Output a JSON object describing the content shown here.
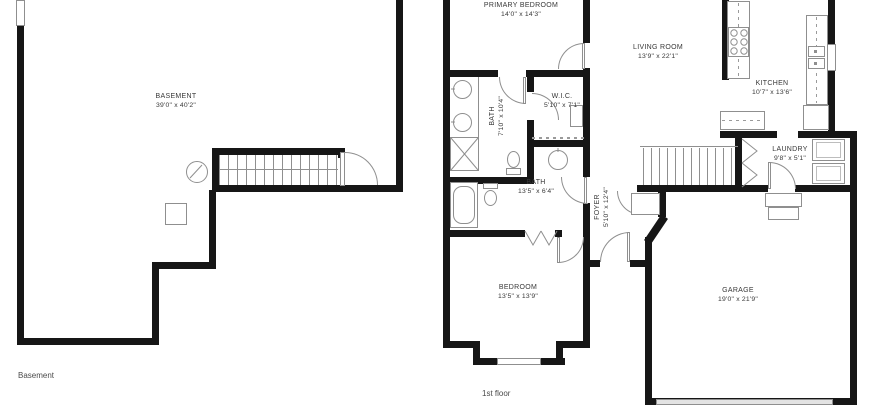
{
  "colors": {
    "wall": "#161616",
    "fixture": "#8f8f8f",
    "text": "#383838"
  },
  "floors": {
    "basement": {
      "caption": "Basement",
      "rooms": {
        "basement": {
          "name": "BASEMENT",
          "dims": "39'0\" x 40'2\""
        }
      }
    },
    "first": {
      "caption": "1st floor",
      "rooms": {
        "primary_bedroom": {
          "name": "PRIMARY BEDROOM",
          "dims": "14'0\" x 14'3\""
        },
        "living_room": {
          "name": "LIVING ROOM",
          "dims": "13'9\" x 22'1\""
        },
        "kitchen": {
          "name": "KITCHEN",
          "dims": "10'7\" x 13'6\""
        },
        "bath_primary": {
          "name": "BATH",
          "dims": "7'10\" x 10'4\""
        },
        "wic": {
          "name": "W.I.C.",
          "dims": "5'10\" x 7'1\""
        },
        "bath_hall": {
          "name": "BATH",
          "dims": "13'5\" x 6'4\""
        },
        "foyer": {
          "name": "FOYER",
          "dims": "5'10\" x 12'4\""
        },
        "laundry": {
          "name": "LAUNDRY",
          "dims": "9'8\" x 5'1\""
        },
        "bedroom": {
          "name": "BEDROOM",
          "dims": "13'5\" x 13'9\""
        },
        "garage": {
          "name": "GARAGE",
          "dims": "19'0\" x 21'9\""
        }
      }
    }
  }
}
